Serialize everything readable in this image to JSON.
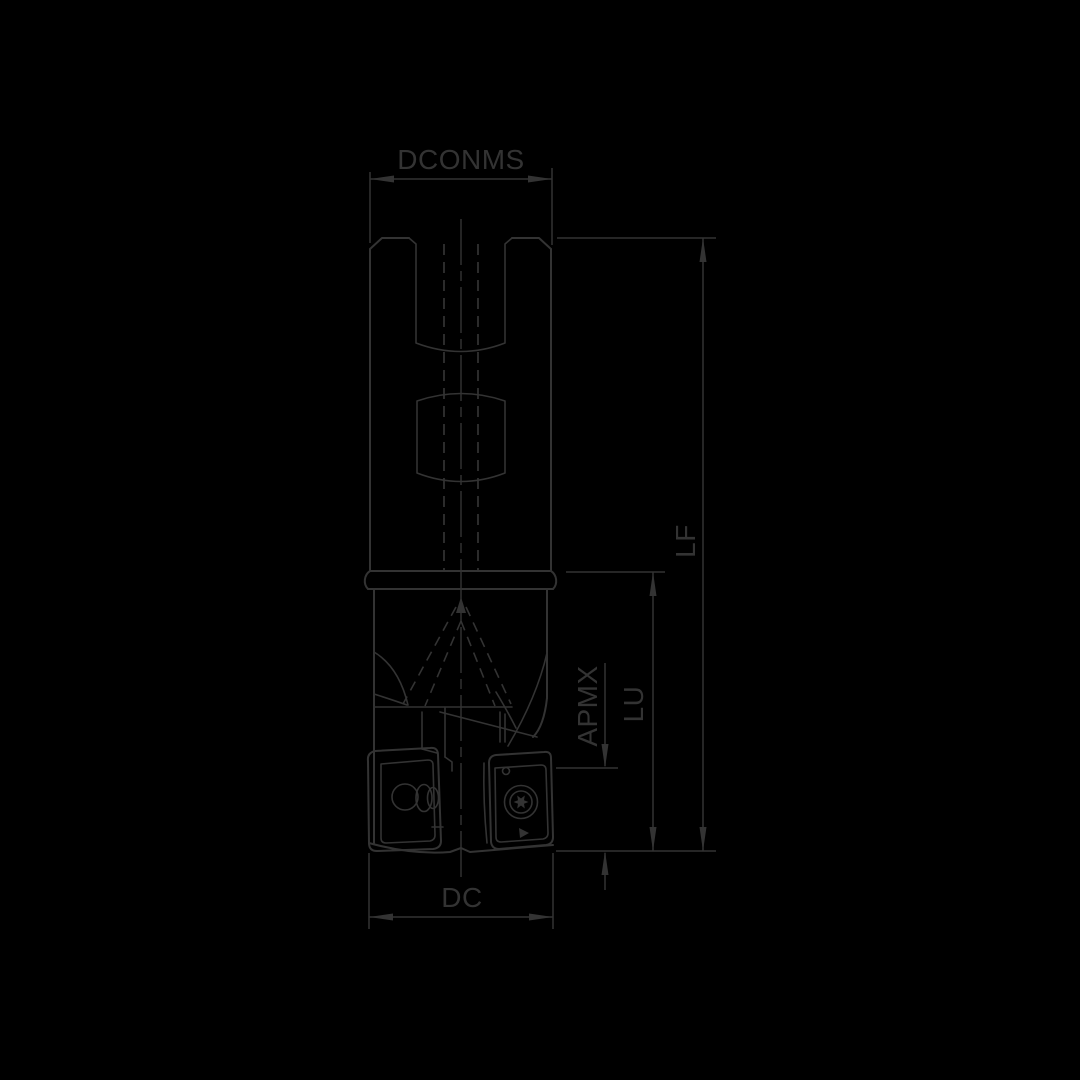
{
  "drawing": {
    "type": "technical-dimension-drawing",
    "subject": "indexable end mill side view",
    "background_color": "#000000",
    "line_color": "#333333",
    "text_color": "#333333"
  },
  "labels": {
    "dconms": "DCONMS",
    "lf": "LF",
    "lu": "LU",
    "apmx": "APMX",
    "dc": "DC"
  }
}
